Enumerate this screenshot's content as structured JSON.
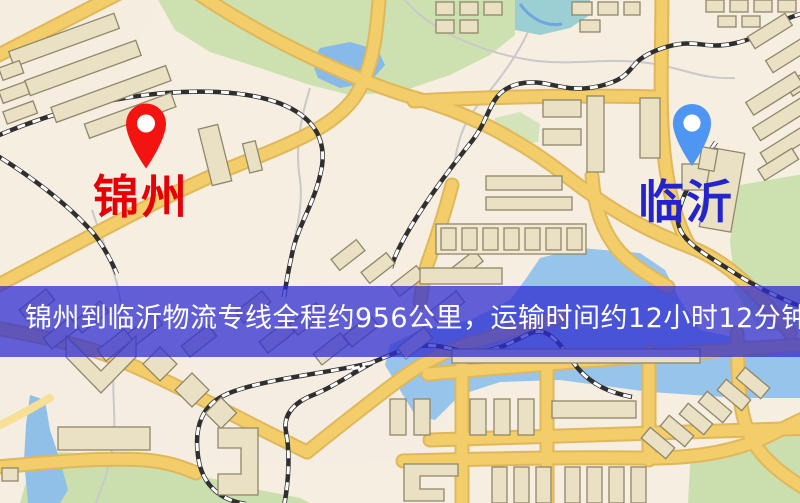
{
  "map": {
    "origin": {
      "label": "锦州",
      "pin_color": "#f31411",
      "label_color": "#e50008"
    },
    "destination": {
      "label": "临沂",
      "pin_color": "#4f95f2",
      "label_color": "#2424cc"
    },
    "banner": {
      "text": "锦州到临沂物流专线全程约956公里，运输时间约12小时12分钟.",
      "background_color": "#2f2dd2",
      "text_color": "#ffffff",
      "distance": "约956公里",
      "duration": "约12小时12分钟"
    },
    "legend_colors": {
      "road": "#f2cd69",
      "building": "#eae0c4",
      "park": "#cde0b0",
      "water": "#93c2ec",
      "railway": "#2f2f2f"
    }
  }
}
